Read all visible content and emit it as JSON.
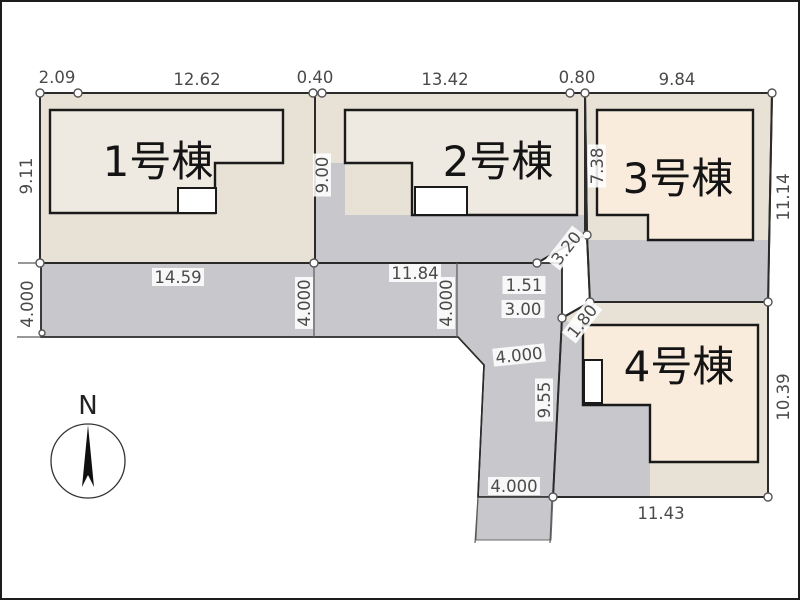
{
  "plan": {
    "buildings": [
      {
        "label": "1号棟"
      },
      {
        "label": "2号棟"
      },
      {
        "label": "3号棟"
      },
      {
        "label": "4号棟"
      }
    ],
    "dimensions": [
      {
        "text": "2.09",
        "x": 57,
        "y": 77,
        "rot": 0
      },
      {
        "text": "12.62",
        "x": 197,
        "y": 79,
        "rot": 0
      },
      {
        "text": "0.40",
        "x": 315,
        "y": 77,
        "rot": 0
      },
      {
        "text": "13.42",
        "x": 445,
        "y": 79,
        "rot": 0
      },
      {
        "text": "0.80",
        "x": 577,
        "y": 77,
        "rot": 0
      },
      {
        "text": "9.84",
        "x": 677,
        "y": 79,
        "rot": 0
      },
      {
        "text": "9.11",
        "x": 26,
        "y": 176,
        "rot": -90
      },
      {
        "text": "9.00",
        "x": 322,
        "y": 175,
        "rot": -90
      },
      {
        "text": "7.38",
        "x": 597,
        "y": 166,
        "rot": -90
      },
      {
        "text": "11.14",
        "x": 783,
        "y": 197,
        "rot": -90
      },
      {
        "text": "14.59",
        "x": 178,
        "y": 277,
        "rot": 0
      },
      {
        "text": "11.84",
        "x": 415,
        "y": 273,
        "rot": 0
      },
      {
        "text": "4.000",
        "x": 27,
        "y": 304,
        "rot": -90
      },
      {
        "text": "4.000",
        "x": 304,
        "y": 303,
        "rot": -90
      },
      {
        "text": "4.000",
        "x": 446,
        "y": 303,
        "rot": -90
      },
      {
        "text": "1.51",
        "x": 524,
        "y": 285,
        "rot": 0
      },
      {
        "text": "3.00",
        "x": 523,
        "y": 309,
        "rot": 0
      },
      {
        "text": "3.20",
        "x": 566,
        "y": 248,
        "rot": -52
      },
      {
        "text": "1.80",
        "x": 582,
        "y": 321,
        "rot": -52
      },
      {
        "text": "9.55",
        "x": 544,
        "y": 400,
        "rot": -90
      },
      {
        "text": "4.000",
        "x": 519,
        "y": 355,
        "rot": -6
      },
      {
        "text": "4.000",
        "x": 514,
        "y": 486,
        "rot": 0
      },
      {
        "text": "10.39",
        "x": 783,
        "y": 397,
        "rot": -90
      },
      {
        "text": "11.43",
        "x": 661,
        "y": 513,
        "rot": 0
      }
    ],
    "compass": {
      "label": "N"
    },
    "colors": {
      "parcel_cream": "#e8e2d6",
      "building_1_2": "#efeae1",
      "building_3_4": "#f9ecdc",
      "road_gray": "#c8c8cc",
      "outline": "#2b2b2b",
      "dimension_text": "#4a4a4a"
    }
  }
}
